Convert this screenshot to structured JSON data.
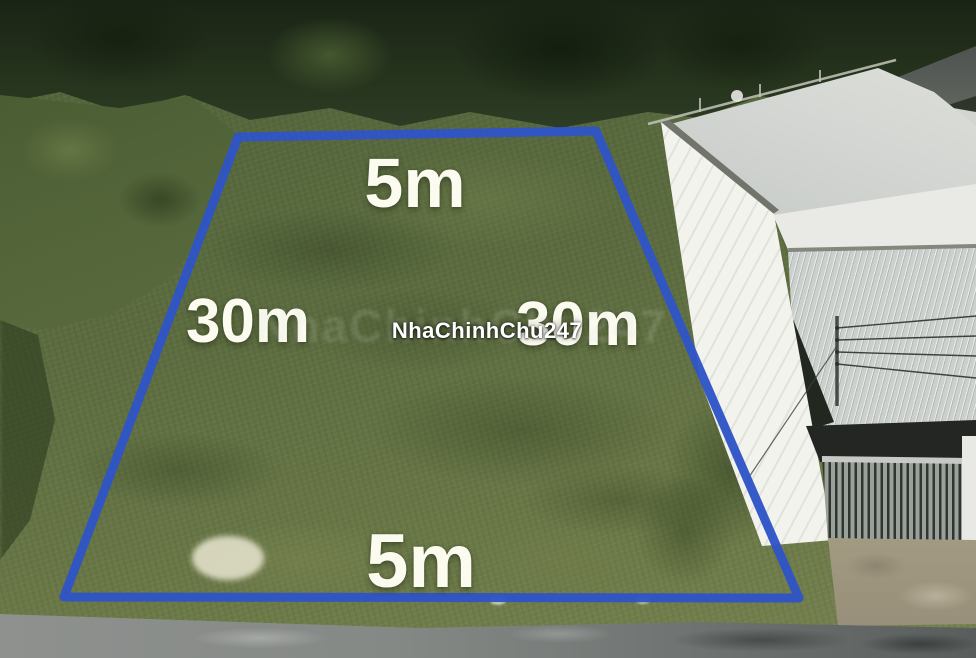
{
  "annotations": {
    "top_width_label": "5m",
    "left_depth_label": "30m",
    "right_depth_label": "30m",
    "bottom_width_label": "5m"
  },
  "watermark": {
    "text": "NhaChinhChu247"
  },
  "colors": {
    "boundary_blue": "#2f55c5",
    "label_text": "#fbfbf0",
    "watermark_text": "#ffffff"
  }
}
